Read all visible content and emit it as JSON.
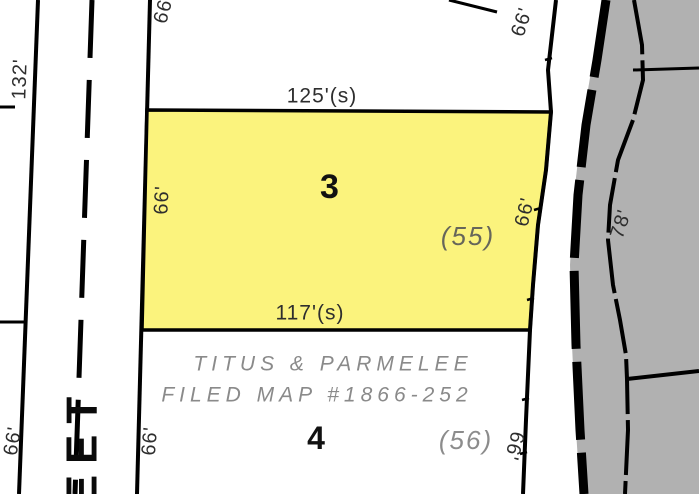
{
  "colors": {
    "background": "#FFFFFF",
    "parcel_highlight": "#FBF37D",
    "adjacent_area": "#B1B1B1",
    "line": "#000000",
    "annotation_gray": "#8A8A8A"
  },
  "map": {
    "street_west": {
      "name_visible": "EET",
      "dim_upper": "132'",
      "dim_lower": "66'"
    },
    "north_parcel": {
      "dim_west": "66'"
    },
    "highlighted_parcel": {
      "number": "3",
      "alt_number": "(55)",
      "frontage_top": "125'(s)",
      "frontage_bottom": "117'(s)",
      "dim_west": "66'",
      "dim_east": "66'"
    },
    "south_parcel": {
      "number": "4",
      "alt_number": "(56)",
      "note_line1": "TITUS & PARMELEE",
      "note_line2": "FILED MAP #1866-252",
      "dim_west": "66'",
      "dim_east": "66'"
    },
    "road_east": {
      "dim_north": "66'",
      "dim_mid": "78'"
    }
  }
}
